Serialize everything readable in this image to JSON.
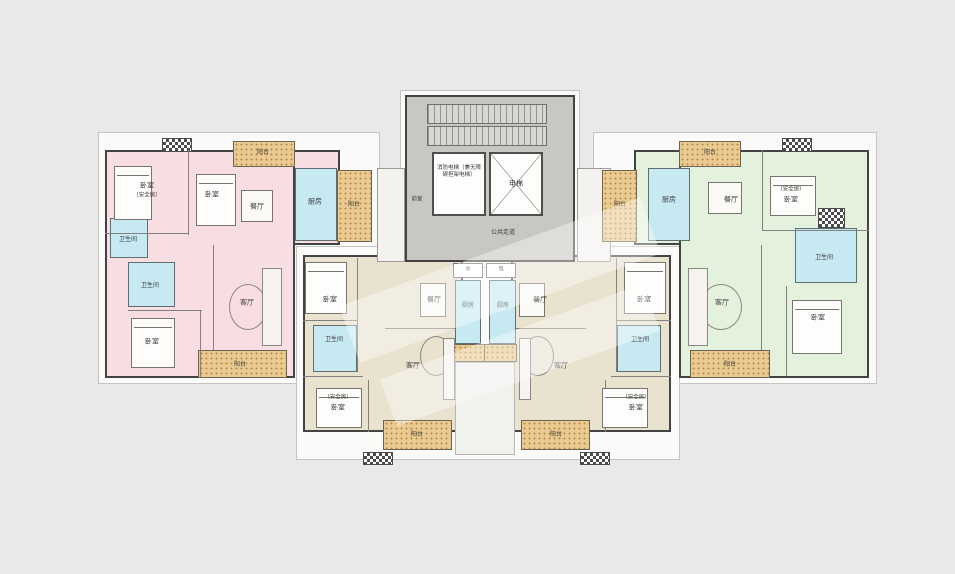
{
  "plan_type": "residential-floor-plan",
  "labels": {
    "bedroom": "卧室",
    "safe_room": "（安全房）",
    "bathroom": "卫生间",
    "kitchen": "厨房",
    "dining": "餐厅",
    "living": "客厅",
    "balcony": "阳台"
  },
  "core": {
    "fire_elevator": "消防电梯（兼无障碍担架电梯）",
    "elevator": "电梯",
    "lobby": "前室",
    "corridor": "公共走道",
    "water_meter": "水",
    "electric_meter": "电"
  },
  "units": {
    "left": {
      "fill": "#f8dee3",
      "rooms": [
        "卧室（安全房）",
        "卧室",
        "餐厅",
        "厨房",
        "卫生间",
        "卫生间",
        "卧室",
        "客厅",
        "阳台",
        "阳台",
        "阳台"
      ]
    },
    "right": {
      "fill": "#e4f1dc",
      "rooms": [
        "厨房",
        "餐厅",
        "卧室（安全房）",
        "卫生间",
        "卧室",
        "客厅",
        "阳台",
        "阳台",
        "阳台"
      ]
    },
    "bottom_left": {
      "fill": "#e9e2cf",
      "rooms": [
        "卧室",
        "卫生间",
        "卧室（安全房）",
        "餐厅",
        "客厅",
        "厨房",
        "阳台"
      ]
    },
    "bottom_right": {
      "fill": "#e9e2cf",
      "rooms": [
        "卧室",
        "卫生间",
        "卧室（安全房）",
        "餐厅",
        "客厅",
        "厨房",
        "阳台"
      ]
    }
  },
  "palette": {
    "background": "#e9e9e8",
    "wall": "#434343",
    "wet_room_blue": "#c6e9f2",
    "balcony_tan": "#eaca90",
    "core_gray": "#c8c7c1"
  }
}
